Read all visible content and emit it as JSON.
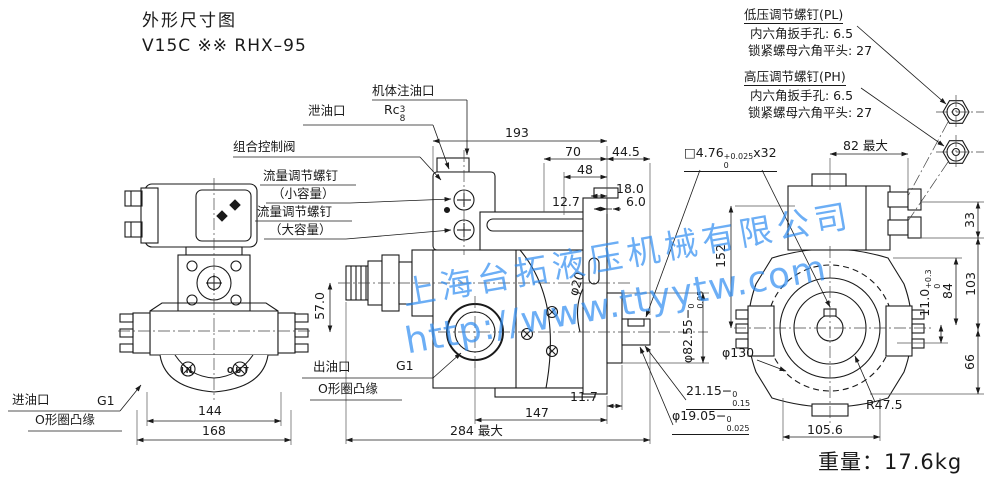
{
  "title": {
    "heading": "外形尺寸图",
    "model": "V15C ※※ RHX–95"
  },
  "weight": {
    "label": "重量：",
    "value": "17.6kg"
  },
  "watermark": {
    "company": "上海台拓液压机械有限公司",
    "url": "http://www.ttyytw.com",
    "color": "#2f8df2"
  },
  "callouts": {
    "pl_title": "低压调节螺钉(PL)",
    "pl_hex": "内六角扳手孔: 6.5",
    "pl_nut": "锁紧螺母六角平头: 27",
    "ph_title": "高压调节螺钉(PH)",
    "ph_hex": "内六角扳手孔: 6.5",
    "ph_nut": "锁紧螺母六角平头: 27",
    "fill_port": "机体注油口",
    "drain_port": "泄油口",
    "drain_thread_base": "Rc",
    "drain_thread_num": "3",
    "drain_thread_den": "8",
    "control_valve": "组合控制阀",
    "flow_small_title": "流量调节螺钉",
    "flow_small_sub": "（小容量）",
    "flow_large_title": "流量调节螺钉",
    "flow_large_sub": "（大容量）",
    "outlet_label": "出油口",
    "outlet_size": "G1",
    "outlet_flange": "O形圈凸缘",
    "inlet_label": "进油口",
    "inlet_size": "G1",
    "inlet_flange": "O形圈凸缘",
    "in_mark": "IN",
    "out_mark": "OUT"
  },
  "dims": {
    "d193": "193",
    "d70": "70",
    "d44_5": "44.5",
    "d48": "48",
    "d18": "18.0",
    "d12_7": "12.7",
    "d6": "6.0",
    "key": {
      "base": "□4.76",
      "tol_top": "+0.025",
      "tol_bot": "0",
      "suffix": "x32"
    },
    "d82max": "82 最大",
    "d33": "33",
    "d152": "152",
    "d103": "103",
    "d84": "84",
    "d11": {
      "base": "11.0",
      "tol_top": "+0.3",
      "tol_bot": "0"
    },
    "d66": "66",
    "dia130": "φ130",
    "r47_5": "R47.5",
    "d105_6": "105.6",
    "d57": "57.0",
    "dia20": "φ20",
    "dia82_55": {
      "base": "φ82.55",
      "sign": "−",
      "tol_top": "0",
      "tol_bot": "0.05"
    },
    "d21_15": {
      "base": "21.15",
      "sign": "−",
      "tol_top": "0",
      "tol_bot": "0.15"
    },
    "dia19_05": {
      "base": "φ19.05",
      "sign": "−",
      "tol_top": "0",
      "tol_bot": "0.025"
    },
    "d11_7": "11.7",
    "d147": "147",
    "d284max": "284 最大",
    "d144": "144",
    "d168": "168"
  }
}
